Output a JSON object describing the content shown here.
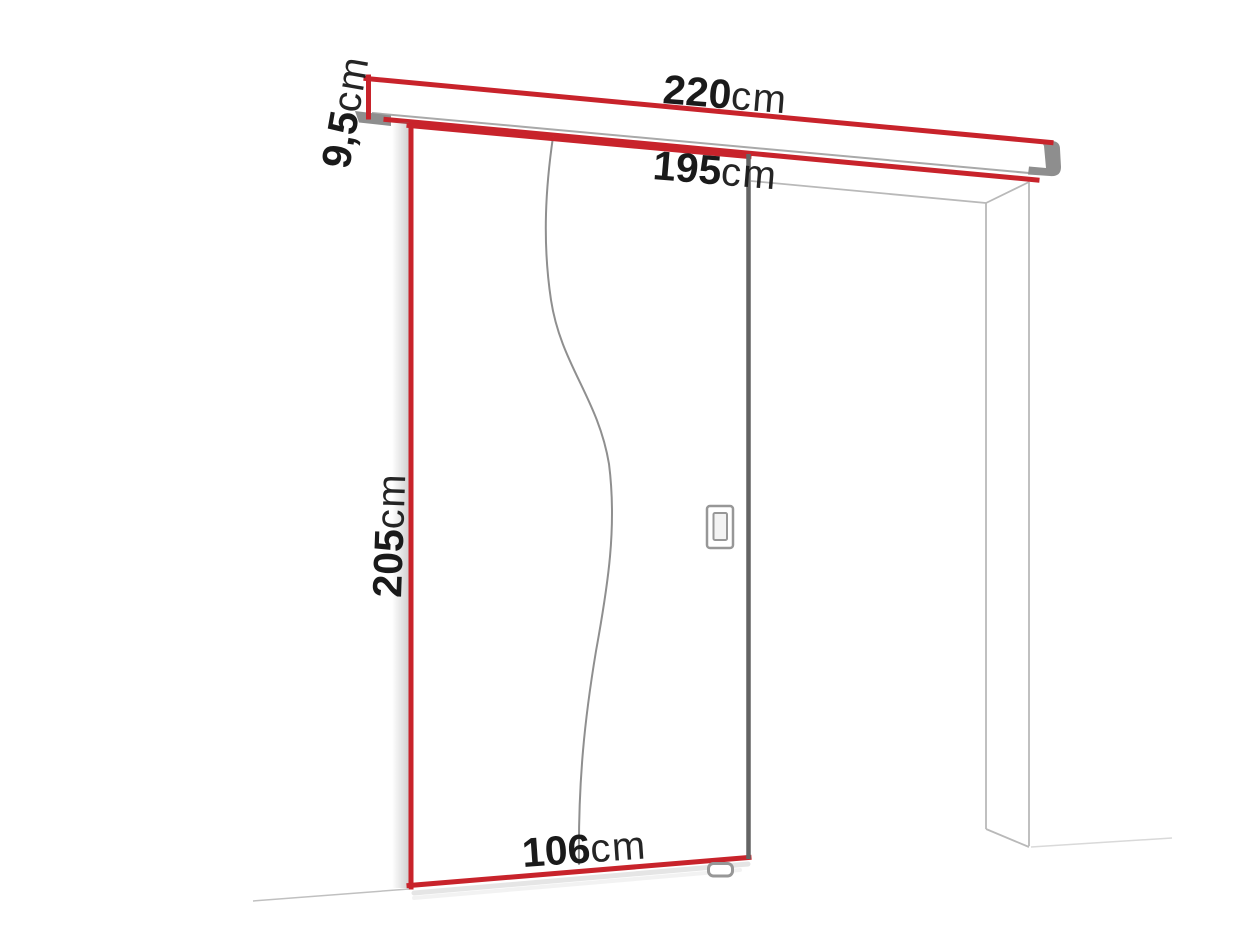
{
  "diagram": {
    "type": "sliding-door-dimension-diagram",
    "labels": {
      "rail_width": {
        "value": "220",
        "unit": "cm"
      },
      "passage_width": {
        "value": "195",
        "unit": "cm"
      },
      "rail_height": {
        "value": "9,5",
        "unit": "cm"
      },
      "door_height": {
        "value": "205",
        "unit": "cm"
      },
      "door_width": {
        "value": "106",
        "unit": "cm"
      }
    },
    "colors": {
      "page_bg": "#ffffff",
      "accent_red": "#c8232b",
      "door_edge_gray": "#646464",
      "rail_cap_gray": "#8e8e8e",
      "frame_line_gray": "#b9b9b9",
      "groove_gray": "#8f8f8f",
      "guide_gray": "#979797",
      "label_text": "#1a1a1a"
    }
  }
}
